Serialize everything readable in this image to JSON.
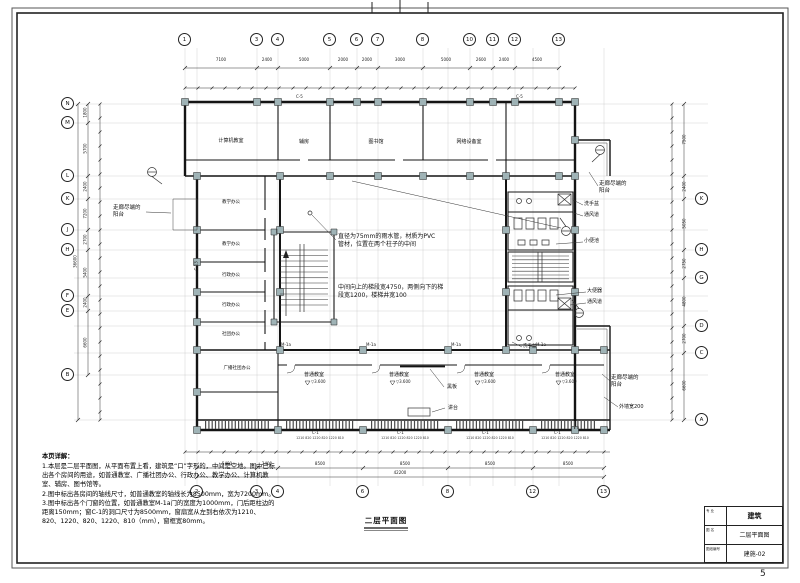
{
  "page": {
    "number": "5"
  },
  "titleblock": {
    "rows": [
      {
        "label": "专 业",
        "value": "建筑"
      },
      {
        "label": "图 名",
        "value": "二层平面图"
      },
      {
        "label": "图纸编号",
        "value": "建施-02"
      }
    ]
  },
  "notes": {
    "heading": "本页详解：",
    "items": [
      "1.本层是二层平面图，从平面布置上看，建筑是“口”字形的，中间是空地。图中已标出各个房间的用途，如普通教室、广播社团办公、行政办公、教学办公、计算机教室、辅房、图书馆等。",
      "2.图中标出各房间的轴线尺寸，如普通教室的轴线长为8500mm，宽为7200mm。",
      "3.图中标出各个门窗的位置，如普通教室M-1a门的宽度为1000mm，门后距柱边的距离150mm；窗C-1的洞口尺寸为8500mm，窗扇宽从左到右依次为1210、820、1220、820、1220、810（mm），窗框宽80mm。"
    ]
  },
  "plan": {
    "title": "二层平面图",
    "axes": {
      "top": [
        "1",
        "3",
        "4",
        "5",
        "6",
        "7",
        "8",
        "10",
        "11",
        "12",
        "13"
      ],
      "bottom": [
        "2",
        "3",
        "4",
        "6",
        "8",
        "12",
        "13"
      ],
      "left": [
        "N",
        "M",
        "L",
        "K",
        "J",
        "H",
        "F",
        "E",
        "B"
      ],
      "right": [
        "K",
        "H",
        "G",
        "D",
        "C",
        "A"
      ]
    },
    "dims": {
      "top": [
        "7100",
        "2400",
        "5000",
        "2000",
        "2000",
        "3000",
        "5000",
        "2600",
        "2400",
        "4500"
      ],
      "bottom": [
        "5400",
        "2400",
        "8500",
        "8500",
        "8500",
        "8500"
      ],
      "bottom_total": "42200",
      "left": [
        "1800",
        "5700",
        "2400",
        "7200",
        "2700",
        "5400",
        "2400",
        "6600"
      ],
      "left_total": "36600",
      "right": [
        "7500",
        "2400",
        "5050",
        "2750",
        "4800",
        "2700",
        "6600"
      ],
      "sash": "1210 820 1220 820 1220 810"
    },
    "rooms": {
      "computer": "计算机教室",
      "aux": "辅房",
      "library": "图书馆",
      "network": "网络设备室",
      "teach": "教学办公",
      "admin": "行政办公",
      "club": "社团办公",
      "broadcast": "广播社团办公",
      "classroom": "普通教室"
    },
    "tags": {
      "door": "M-1a",
      "window": "C-1",
      "window_top": "C-5",
      "window_left": "C-13"
    },
    "ann": {
      "pipe": "直径为75mm的雨水管，材质为PVC管材，位置在两个柱子的中间",
      "stair": "中间向上的梯段宽4750，两侧向下的梯段宽1200，楼梯井宽100",
      "balcony": "走廊尽端的阳台",
      "extwall": "外墙宽200",
      "blackboard": "黑板",
      "podium": "讲台",
      "basin": "洗手盆",
      "vent": "通风道",
      "urinal": "小便池",
      "wc": "大便器",
      "level": "▽3.600"
    }
  }
}
